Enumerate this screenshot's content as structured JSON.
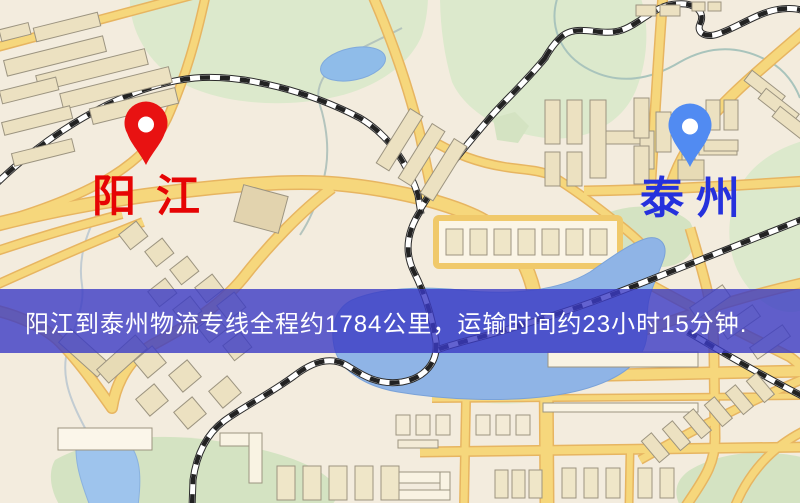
{
  "markers": {
    "origin": {
      "label": "阳江"
    },
    "destination": {
      "label": "泰州"
    }
  },
  "banner": {
    "text": "阳江到泰州物流专线全程约1784公里，运输时间约23小时15分钟.",
    "distance_km": "1784",
    "duration": "23小时15分钟"
  },
  "theme": {
    "banner_bg": "rgba(59,59,196,0.8)",
    "origin_label_color": "#e60404",
    "origin_pin_color": "#e81212",
    "destination_label_color": "#2531dd",
    "destination_pin_color": "#518bf2",
    "map_bg": "#f3ecde",
    "road_color": "#f6d77c",
    "road_casing_color": "#e7b561",
    "water_color": "#8fb4e6",
    "park_color": "#dce9cc",
    "railway_dark": "#2b2b2b",
    "building_fill": "#ece1c1"
  }
}
